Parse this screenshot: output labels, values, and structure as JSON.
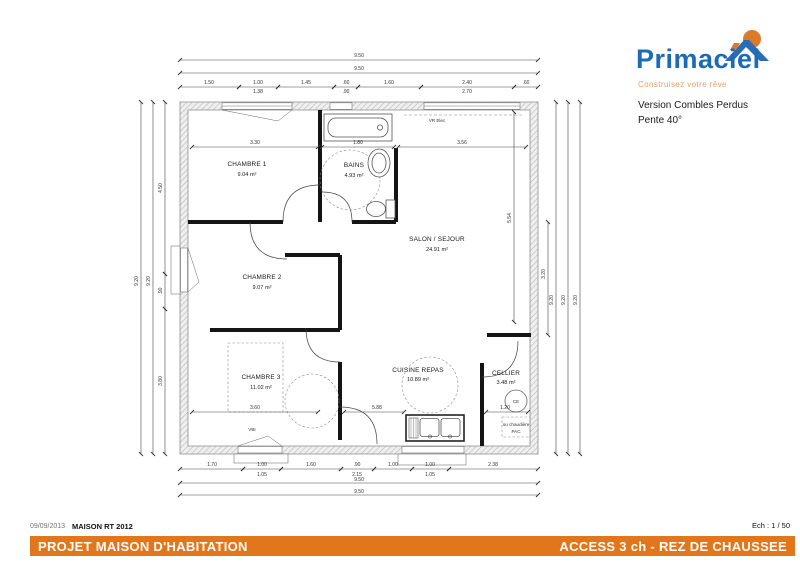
{
  "header": {
    "logo": {
      "name": "Primaciel",
      "tagline": "Construisez votre rêve"
    },
    "version_line1": "Version Combles Perdus",
    "version_line2": "Pente 40°"
  },
  "plan": {
    "rooms": [
      {
        "name": "CHAMBRE 1",
        "area": "9.04 m²"
      },
      {
        "name": "BAINS",
        "area": "4.93 m²"
      },
      {
        "name": "SALON / SEJOUR",
        "area": "24.91 m²"
      },
      {
        "name": "CHAMBRE 2",
        "area": "9.07 m²"
      },
      {
        "name": "CHAMBRE 3",
        "area": "11.02 m²"
      },
      {
        "name": "CUISINE REPAS",
        "area": "10.89 m²"
      },
      {
        "name": "CELLIER",
        "area": "3.48 m²"
      }
    ],
    "annotations": {
      "vr_elec": "VR Elec",
      "vbi": "VBI",
      "ce": "CE",
      "chaudiere_1": "ou chaudière",
      "chaudiere_2": "PAC"
    },
    "dimensions": {
      "top": {
        "overall_1": "9.50",
        "overall_2": "9.50",
        "segments": [
          "1.50",
          "1.00",
          "1.45",
          ".60",
          "1.60",
          "2.40",
          ".60"
        ],
        "sub": [
          "1.38",
          ".90",
          "2.70"
        ]
      },
      "bottom": {
        "overall_1": "9.50",
        "overall_2": "9.50",
        "segments": [
          "1.70",
          "1.00",
          "1.60",
          ".90",
          "1.00",
          "1.00",
          "2.38"
        ],
        "sub": [
          "1.05",
          "2.15",
          "1.05"
        ]
      },
      "left": {
        "overall_1": "9.20",
        "overall_2": "9.20",
        "segments": [
          "4.50",
          ".90",
          "3.80"
        ]
      },
      "right": {
        "overall_1": "9.20",
        "overall_2": "9.20",
        "overall_3": "9.20"
      },
      "interior": {
        "chambre1_w": "3.30",
        "bains_w": "1.80",
        "salon_w": "3.56",
        "salon_h": "5.54",
        "right_h": "3.20",
        "chambre3_w": "3.60",
        "cuisine_w": "5.88",
        "cellier_w": "1.20"
      }
    }
  },
  "footer": {
    "date": "09/09/2013",
    "doc_ref": "MAISON RT 2012",
    "scale": "Ech : 1 / 50",
    "title_left": "PROJET MAISON D'HABITATION",
    "title_right": "ACCESS 3 ch - REZ DE CHAUSSEE"
  },
  "colors": {
    "accent_orange": "#E2761B",
    "logo_blue": "#1C6BB5",
    "logo_orange": "#E8A160"
  }
}
